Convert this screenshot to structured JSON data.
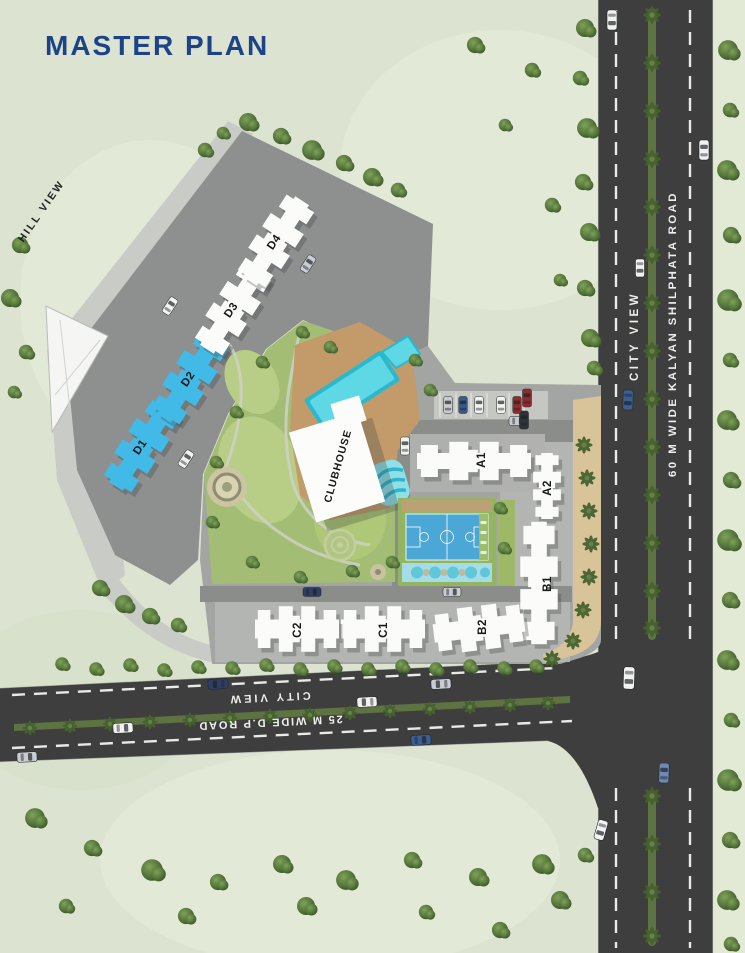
{
  "title": "MASTER PLAN",
  "corner_label": "HILL VIEW",
  "roads": {
    "vertical": {
      "lane_label": "CITY VIEW",
      "name": "60 M WIDE KALYAN SHILPHATA ROAD"
    },
    "horizontal": {
      "lane_label": "CITY VIEW",
      "name": "25 M WIDE D.P ROAD"
    }
  },
  "clubhouse": {
    "label": "CLUBHOUSE"
  },
  "buildings": [
    {
      "label": "D1",
      "highlighted": true
    },
    {
      "label": "D2",
      "highlighted": true
    },
    {
      "label": "D3",
      "highlighted": false
    },
    {
      "label": "D4",
      "highlighted": false
    },
    {
      "label": "A1",
      "highlighted": false
    },
    {
      "label": "A2",
      "highlighted": false
    },
    {
      "label": "B1",
      "highlighted": false
    },
    {
      "label": "B2",
      "highlighted": false
    },
    {
      "label": "C1",
      "highlighted": false
    },
    {
      "label": "C2",
      "highlighted": false
    }
  ],
  "amenities": [
    "swimming-pool",
    "clubhouse",
    "basketball-court",
    "kids-pool",
    "central-garden",
    "tensile-canopy"
  ],
  "colors": {
    "title_navy": "#1C4388",
    "highlighted_tower_blue": "#41BAE7",
    "tower_white": "#FBFBF9",
    "road_asphalt": "#3D3E3D",
    "background_green": "#DCE4D1",
    "pool_cyan": "#3ECBDD",
    "pool_deck_tan": "#C39A6A",
    "sports_court_blue": "#4FA8D5"
  }
}
